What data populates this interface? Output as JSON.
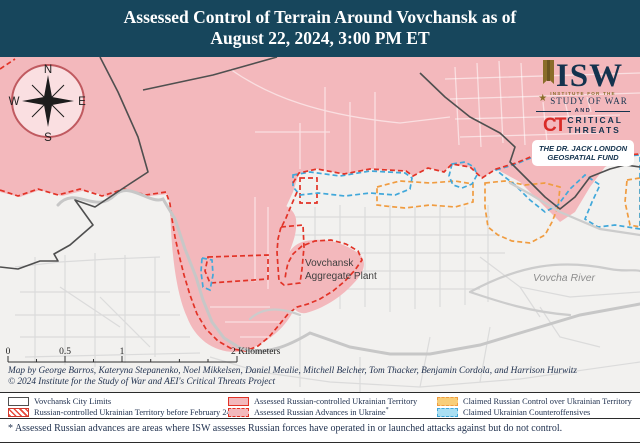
{
  "title": {
    "line1": "Assessed Control of Terrain Around Vovchansk as of",
    "line2": "August 22, 2024, 3:00 PM ET"
  },
  "logos": {
    "isw": "ISW",
    "institute_line": "INSTITUTE FOR THE",
    "study_line": "STUDY OF WAR",
    "and": "AND",
    "ct": "CT",
    "critical": "CRITICAL",
    "threats": "THREATS",
    "fund_line1": "THE DR. JACK LONDON",
    "fund_line2": "GEOSPATIAL FUND"
  },
  "compass": {
    "n": "N",
    "e": "E",
    "s": "S",
    "w": "W"
  },
  "map_labels": {
    "plant_line1": "Vovchansk",
    "plant_line2": "Aggregate Plant",
    "river": "Vovcha River"
  },
  "scale_bar": {
    "tick0": "0",
    "tick05": "0.5",
    "tick1": "1",
    "tick2": "2 Kilometers"
  },
  "attribution": {
    "line1": "Map by George Barros, Kateryna Stepanenko, Noel Mikkelsen, Daniel Mealie, Mitchell Belcher, Tom Thacker, Benjamin Cordola, and Harrison Hurwitz",
    "line2": "© 2024 Institute for the Study of War and AEI's Critical Threats Project"
  },
  "legend": {
    "items": [
      {
        "label": "Vovchansk City Limits"
      },
      {
        "label": "Russian-controlled Ukrainian Territory before February 24"
      },
      {
        "label": "Assessed Russian-controlled Ukrainian Territory"
      },
      {
        "label": "Assessed Russian Advances in Ukraine",
        "sup": "*"
      },
      {
        "label": "Claimed Russian Control over Ukrainian Territory"
      },
      {
        "label": "Claimed Ukrainian Counteroffensives"
      }
    ]
  },
  "footnote": "* Assessed Russian advances are areas where ISW assesses Russian forces have operated in or launched attacks against but do not control.",
  "colors": {
    "titlebar": "#17465C",
    "pink": "#F3B8BC",
    "red": "#E23327",
    "yellow": "#F8CE79",
    "orange": "#F09C40",
    "bluefill": "#A9DFF3",
    "blueline": "#41A8DA",
    "navy": "#1E2F4D",
    "ctred": "#D92B27"
  }
}
